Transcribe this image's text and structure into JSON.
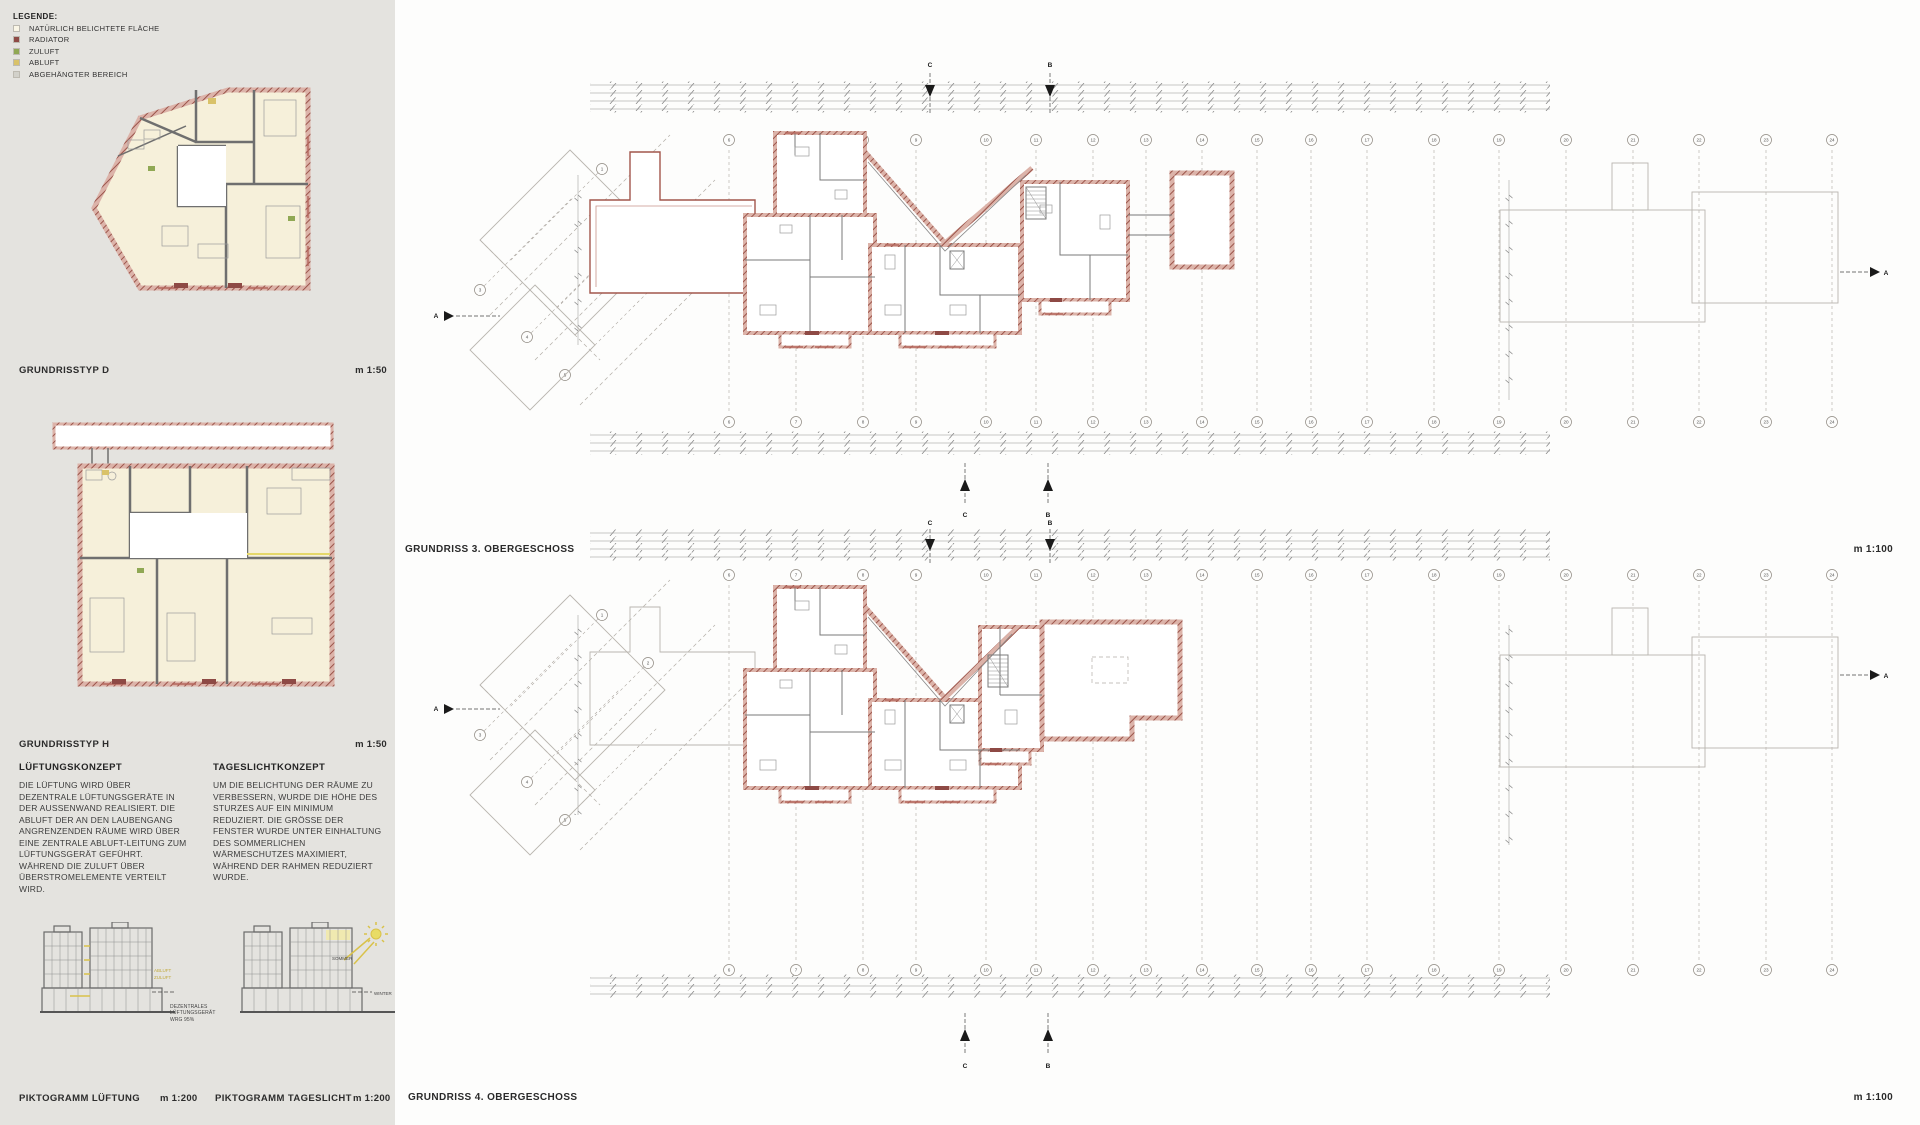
{
  "sheet": {
    "background": "#fdfdfc",
    "sidebar_background": "#e4e3df",
    "wall_color": "#9b584e",
    "accent_yellow": "#d9c269",
    "accent_green": "#90a854",
    "accent_red": "#8e4a45"
  },
  "sidebar": {
    "legend": {
      "title": "Legende:",
      "items": [
        {
          "label": "natürlich belichtete Fläche",
          "color": "#faf6e6"
        },
        {
          "label": "Radiator",
          "color": "#8e4a45"
        },
        {
          "label": "Zuluft",
          "color": "#90a854"
        },
        {
          "label": "Abluft",
          "color": "#d9c269"
        },
        {
          "label": "abgehängter Bereich",
          "color": "#d2d1ca"
        }
      ]
    },
    "typ_d": {
      "label": "Grundrisstyp D",
      "scale": "m 1:50"
    },
    "typ_h": {
      "label": "Grundrisstyp H",
      "scale": "m 1:50"
    },
    "concepts": {
      "ventilation": {
        "heading": "Lüftungskonzept",
        "body": "Die Lüftung wird über dezentrale Lüftungsgeräte in der Außenwand realisiert. Die Abluft der an den Laubengang angrenzenden Räume wird über eine zentrale Abluft-Leitung zum Lüftungsgerät geführt. Während die Zuluft über Überstromelemente verteilt wird."
      },
      "daylight": {
        "heading": "Tageslichtkonzept",
        "body": "Um die Belichtung der Räume zu verbessern, wurde die Höhe des Sturzes auf ein Minimum reduziert. Die Größe der Fenster wurde unter Einhaltung des sommerlichen Wärmeschutzes maximiert, während der Rahmen reduziert wurde."
      }
    },
    "pictograms": {
      "ventilation": {
        "label": "Piktogramm Lüftung",
        "scale": "m 1:200",
        "annotation": "Dezentrales Lüftungsgerät WRG 95%",
        "tag_abluft": "Abluft",
        "tag_zuluft": "Zuluft"
      },
      "daylight": {
        "label": "Piktogramm Tageslicht",
        "scale": "m 1:200",
        "tag_sommer": "Sommer",
        "tag_winter": "Winter"
      }
    }
  },
  "plans": {
    "og3": {
      "title": "Grundriss 3. Obergeschoss",
      "scale": "m 1:100"
    },
    "og4": {
      "title": "Grundriss 4. Obergeschoss",
      "scale": "m 1:100"
    },
    "grid": {
      "diagonal_labels": [
        "1",
        "2",
        "3",
        "4",
        "5"
      ],
      "vertical_labels": [
        "6",
        "7",
        "8",
        "9",
        "10",
        "11",
        "12",
        "13",
        "14",
        "15",
        "16",
        "17",
        "18",
        "19",
        "20",
        "21",
        "22",
        "23",
        "24"
      ]
    },
    "section_markers": {
      "section_a": "A",
      "section_b": "B",
      "section_c": "C"
    }
  }
}
